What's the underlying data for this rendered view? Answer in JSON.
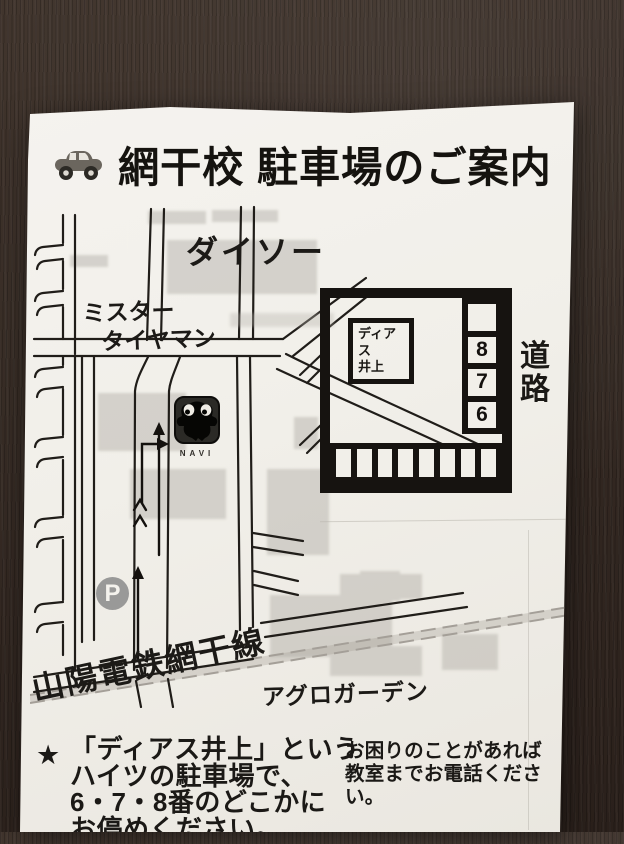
{
  "title": {
    "text": "網干校 駐車場のご案内"
  },
  "icons": {
    "car": "car-side-icon",
    "parking": "parking-p-icon",
    "navi_mascot": "navi-mascot-icon"
  },
  "map": {
    "labels": {
      "daiso": "ダイソー",
      "tireman_line1": "ミスター",
      "tireman_line2": "タイヤマン",
      "navi": "NAVI",
      "parking_mark": "P",
      "railway": "山陽電鉄網干線",
      "agro": "アグロガーデン"
    }
  },
  "inset": {
    "building": {
      "line1": "ディアス",
      "line2": "井上"
    },
    "spot_numbers": [
      "8",
      "7",
      "6"
    ],
    "road_vertical": [
      "道",
      "路"
    ]
  },
  "notes": {
    "star": "★",
    "left": [
      "「ディアス井上」という",
      "ハイツの駐車場で、",
      "6・7・8番のどこかに",
      "お停めください。"
    ],
    "right": [
      "お困りのことがあれば",
      "教室までお電話ください。"
    ]
  },
  "colors": {
    "paper": "#f2f0ea",
    "ink": "#1b1916",
    "wood": "#362b24",
    "building_gray": "#b6b2ab",
    "p_badge_gray": "#8f8f8f"
  }
}
